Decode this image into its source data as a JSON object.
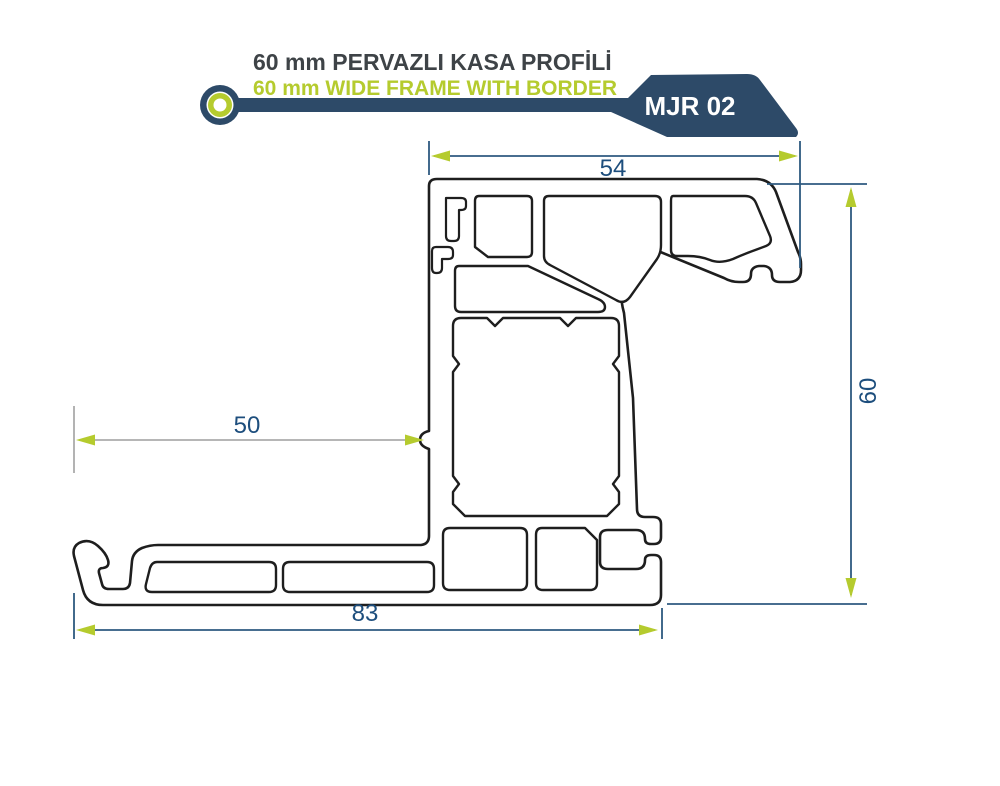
{
  "header": {
    "title": "60 mm PERVAZLI KASA PROFİLİ",
    "subtitle": "60 mm WIDE FRAME WITH BORDER",
    "badge_code": "MJR 02"
  },
  "dimensions": {
    "top_width_mm": "54",
    "mid_width_mm": "50",
    "bottom_width_mm": "83",
    "right_height_mm": "60"
  },
  "colors": {
    "navy": "#2d4a68",
    "lime": "#b5cb2e",
    "dim_line": "#2e5a80",
    "dim_text": "#1d4e7d",
    "gray_line": "#ababab",
    "outline": "#1e1e1e",
    "title_text": "#3e4347",
    "badge_text": "#ffffff"
  }
}
